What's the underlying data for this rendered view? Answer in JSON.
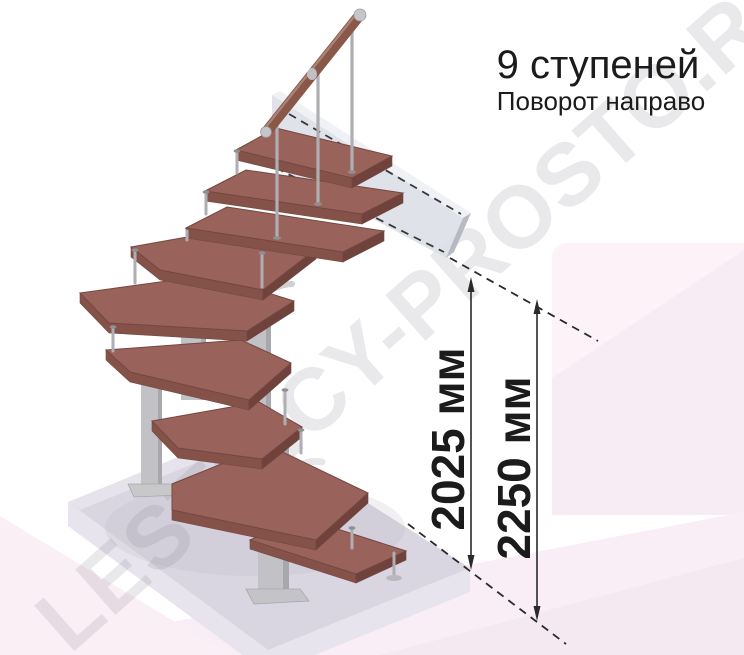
{
  "illustration": {
    "title": "9 ступеней",
    "subtitle": "Поворот направо",
    "watermark": "LESTNICY-PROSTO.RU",
    "dimensions": [
      {
        "label": "2025 мм"
      },
      {
        "label": "2250 мм"
      }
    ]
  },
  "colors": {
    "ink": "#1b1b1b",
    "wood_top": "#99635b",
    "wood_face": "#85524a",
    "wood_side": "#6f433c",
    "wood_edge": "#744740",
    "metal": "#c2c2c6",
    "metal_dark": "#a7a7ac",
    "rod": "#aeaeb3",
    "handrail_wood": "#8a5848",
    "slab_top": "#d9d5e1",
    "slab_face": "#e7e4ed",
    "wall_front": "#dee0e8",
    "wall_top": "#eef0f5",
    "wall_end": "#b4b6c0",
    "pink_light": "#fdf2f8",
    "pink_mid": "#f7ecf3",
    "pink_soft": "#fbeff6",
    "pink_wedge": "#f9eef5",
    "pink_deep": "#f4e9f0",
    "watermark_gray": "#8b8692",
    "dim_line": "#2a2a2a"
  }
}
